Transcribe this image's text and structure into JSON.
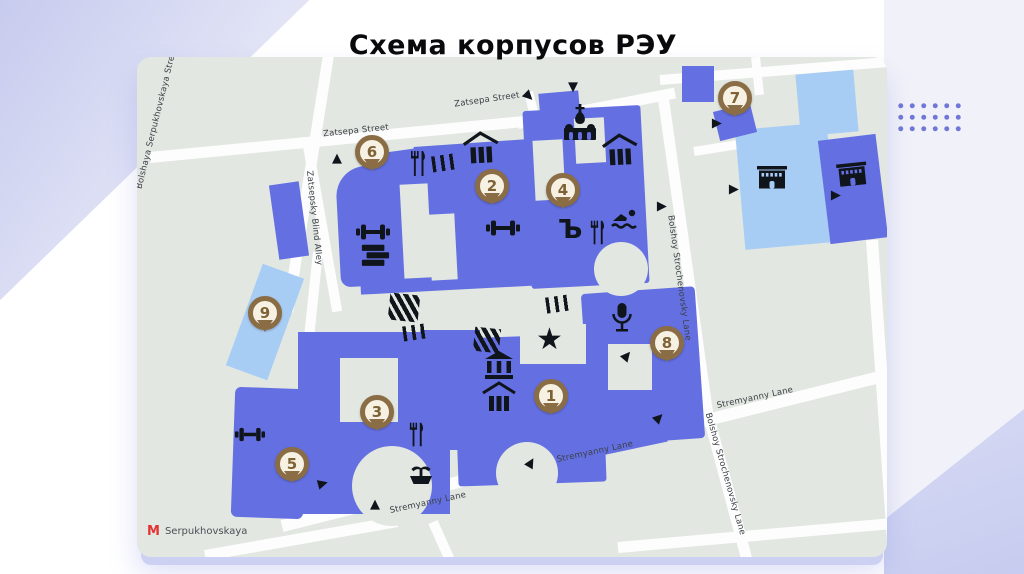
{
  "title": "Схема корпусов РЭУ",
  "map": {
    "street_labels": {
      "bolshaya_serpukhovskaya": "Bolshaya Serpukhovskaya Street",
      "zatsepa_1": "Zatsepa Street",
      "zatsepa_2": "Zatsepa Street",
      "zatsepsky_blind_alley": "Zatsepsky Blind Alley",
      "bolshoy_strochenovsky_1": "Bolshoy Strochenovsky Lane",
      "bolshoy_strochenovsky_2": "Bolshoy Strochenovsky Lane",
      "stremyanny_1": "Stremyanny Lane",
      "stremyanny_2": "Stremyanny Lane",
      "stremyanny_3": "Stremyanny Lane"
    },
    "pins": [
      {
        "label": "1"
      },
      {
        "label": "2"
      },
      {
        "label": "3"
      },
      {
        "label": "4"
      },
      {
        "label": "5"
      },
      {
        "label": "6"
      },
      {
        "label": "7"
      },
      {
        "label": "8"
      },
      {
        "label": "9"
      }
    ],
    "metro": {
      "symbol": "M",
      "name": "Serpukhovskaya"
    },
    "glyphs": {
      "star": "★",
      "triangle": "▲",
      "hard_sign": "Ъ"
    },
    "colors": {
      "building": "#6470e2",
      "building_light": "#a8cdf4",
      "pin": "#8a6d45",
      "map_background": "#e2e7e2",
      "street": "#fdfdfd",
      "icon": "#10151c",
      "metro_red": "#e23333",
      "accent_lavender": "#c9cdf0"
    }
  }
}
